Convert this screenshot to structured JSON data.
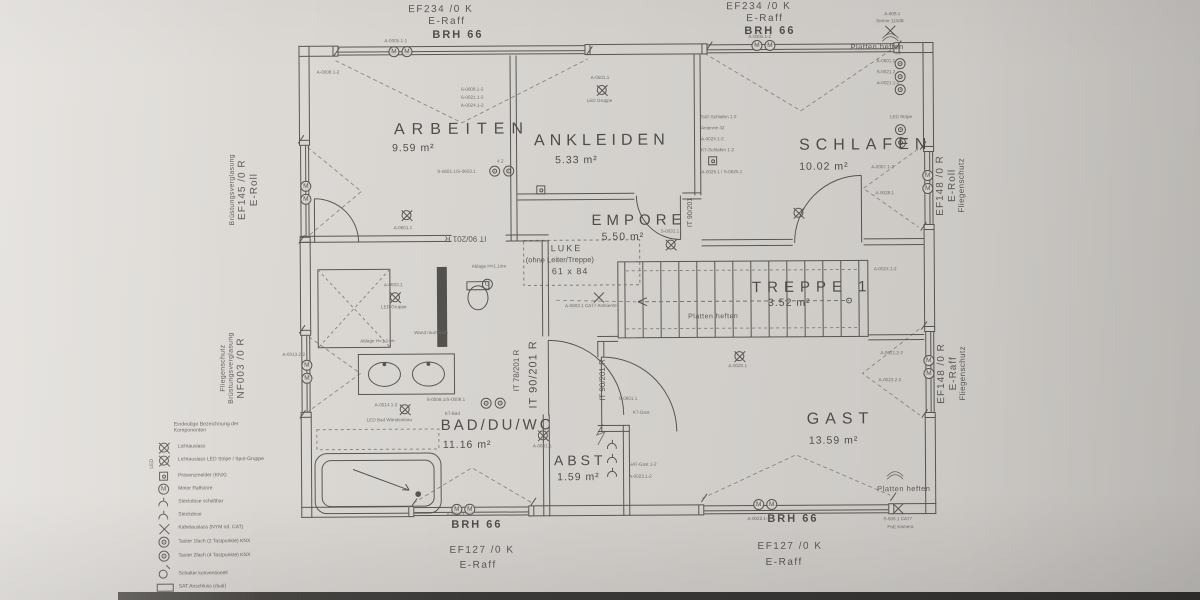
{
  "rooms": [
    {
      "name": "ARBEITEN",
      "area": "9.59 m²"
    },
    {
      "name": "ANKLEIDEN",
      "area": "5.33 m²"
    },
    {
      "name": "SCHLAFEN",
      "area": "10.02 m²"
    },
    {
      "name": "EMPORE",
      "area": "5.50 m²"
    },
    {
      "name": "TREPPE 1",
      "area": "3.52 m²"
    },
    {
      "name": "BAD/DU/WC",
      "area": "11.16 m²"
    },
    {
      "name": "ABST",
      "area": "1.59 m²"
    },
    {
      "name": "GAST",
      "area": "13.59 m²"
    }
  ],
  "windows": {
    "top_left": {
      "code": "EF234 /0 K",
      "shade": "E-Raff",
      "sill": "BRH 66"
    },
    "top_right": {
      "code": "EF234 /0 K",
      "shade": "E-Raff",
      "sill": "BRH 66"
    },
    "bottom_left": {
      "code": "EF127 /0 K",
      "shade": "E-Raff",
      "sill": "BRH 66"
    },
    "bottom_right": {
      "code": "EF127 /0 K",
      "shade": "E-Raff",
      "sill": "BRH 66"
    },
    "left_upper": {
      "code": "EF145 /0 R",
      "shade": "E-Roll",
      "note": "Brüstungsverglasung"
    },
    "left_lower": {
      "code": "NF003 /0 R",
      "note": "Brüstungsverglasung",
      "note2": "Fliegenschutz"
    },
    "right_upper": {
      "code": "EF148 /0 R",
      "shade": "E-Roll",
      "note": "Fliegenschutz"
    },
    "right_lower": {
      "code": "EF148 /0 R",
      "shade": "E-Raff",
      "note": "Fliegenschutz"
    }
  },
  "doors": [
    "IT 90/201 R",
    "IT 90/201 R",
    "IT 90/201 R",
    "IT 78/201 R",
    "IT 90/201"
  ],
  "luke": {
    "title": "LUKE",
    "subtitle": "(ohne Leiter/Treppe)",
    "size": "61 x 84"
  },
  "notes": {
    "platten": "Platten heften"
  },
  "legend": {
    "header": "Eindeutige Bezeichnung der Komponenten",
    "led_side": "LED",
    "items": [
      {
        "symbol": "light-outlet-icon",
        "label": "Lichtauslass"
      },
      {
        "symbol": "light-outlet-icon",
        "label": "Lichtauslass LED Stripe / Spot-Gruppe"
      },
      {
        "symbol": "presence-detector-icon",
        "label": "Präsenzmelder (KNX)"
      },
      {
        "symbol": "motor-icon",
        "label": "Motor Raffstore"
      },
      {
        "symbol": "socket-switched-icon",
        "label": "Steckdose schaltbar"
      },
      {
        "symbol": "socket-icon",
        "label": "Steckdose"
      },
      {
        "symbol": "cable-outlet-icon",
        "label": "Kabelauslass (NYM od. CAT)"
      },
      {
        "symbol": "button-1x-icon",
        "label": "Taster 1fach (2 Tastpunkte) KNX"
      },
      {
        "symbol": "button-2x-icon",
        "label": "Taster 2fach (4 Tastpunkte) KNX"
      },
      {
        "symbol": "switch-icon",
        "label": "Schalter konventionell"
      },
      {
        "symbol": "sat-outlet-icon",
        "label": "SAT Anschluss (dual)"
      },
      {
        "symbol": "lan-outlet-icon",
        "label": "COX/LAN Anschlussdose (dual)"
      }
    ]
  },
  "annotations": [
    "A-0005.1-1",
    "S-0008.1-2",
    "S-0021.1-2",
    "A-0024.1-2",
    "A-0501.1",
    "LED Gruppe",
    "S-0601.1/S-0603.1",
    "4  2",
    "A-0601.1",
    "A-0008.1-2",
    "SAT-Schlafen 1-2",
    "Antenne 42",
    "A-0024.1-2",
    "KT-Schlafen 1-2",
    "A-0026.1 / S-0625.1",
    "4  2",
    "A-0601.2",
    "S-0021.2",
    "A-0021.1-2",
    "LED Stripe",
    "A-0007.1-2",
    "A-0028.1",
    "A-608.1",
    "Sirene 110dB",
    "A-0603.1",
    "LED Gruppe",
    "Ablage H=1.14m",
    "Wand raumhoch",
    "Ablage H=1.14m",
    "A-0014.1-2",
    "LED Bad Wandeinbau",
    "S-0008.1/S-0008.1",
    "KT-Bad",
    "A-0013.2-2",
    "A-0601.1",
    "S-0601.1",
    "KT-Gast",
    "A-0020.1",
    "A-0024.1-2",
    "A-0021.2-2",
    "A-0023.2-2",
    "A-0022.1-2",
    "A-0011-1",
    "S-608.1 CAT7",
    "PoE Kamera",
    "S-0031.1",
    "A-0603.1 CAT7 Ambiente",
    "A-0005.1-2",
    "SAT-Gast 1-2",
    "A-0023.1-2"
  ]
}
